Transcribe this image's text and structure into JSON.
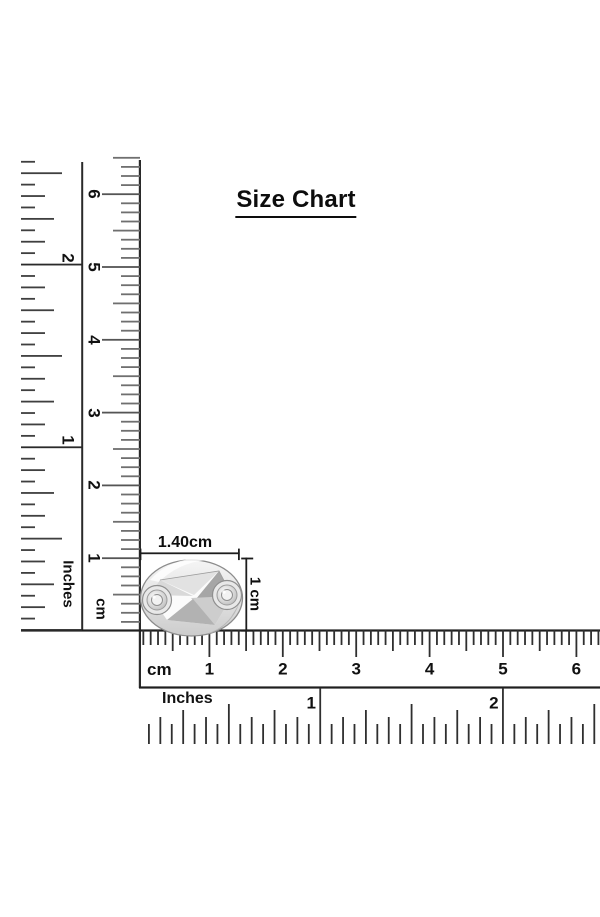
{
  "title": "Size Chart",
  "rulers": {
    "vertical_inches": {
      "label": "Inches",
      "numbers": [
        "1",
        "2"
      ]
    },
    "vertical_cm": {
      "label": "cm",
      "numbers": [
        "1",
        "2",
        "3",
        "4",
        "5",
        "6"
      ]
    },
    "horizontal_cm": {
      "label": "cm",
      "numbers": [
        "1",
        "2",
        "3",
        "4",
        "5",
        "6"
      ]
    },
    "horizontal_inches": {
      "label": "Inches",
      "numbers": [
        "1",
        "2"
      ]
    }
  },
  "dimensions": {
    "width_label": "1.40cm",
    "height_label": "1 cm"
  },
  "object": {
    "name": "silver-twisted-ring-with-side-rivets"
  },
  "colors": {
    "ink": "#1f1f1f",
    "tick_dark": "#3d3d3d",
    "tick_grey": "#6f6f6f",
    "metal_edge": "#8c8c8c",
    "metal_light": "#f4f4f4",
    "metal_mid": "#cfcfcf",
    "metal_dark": "#a8a8a8",
    "background": "#ffffff"
  }
}
